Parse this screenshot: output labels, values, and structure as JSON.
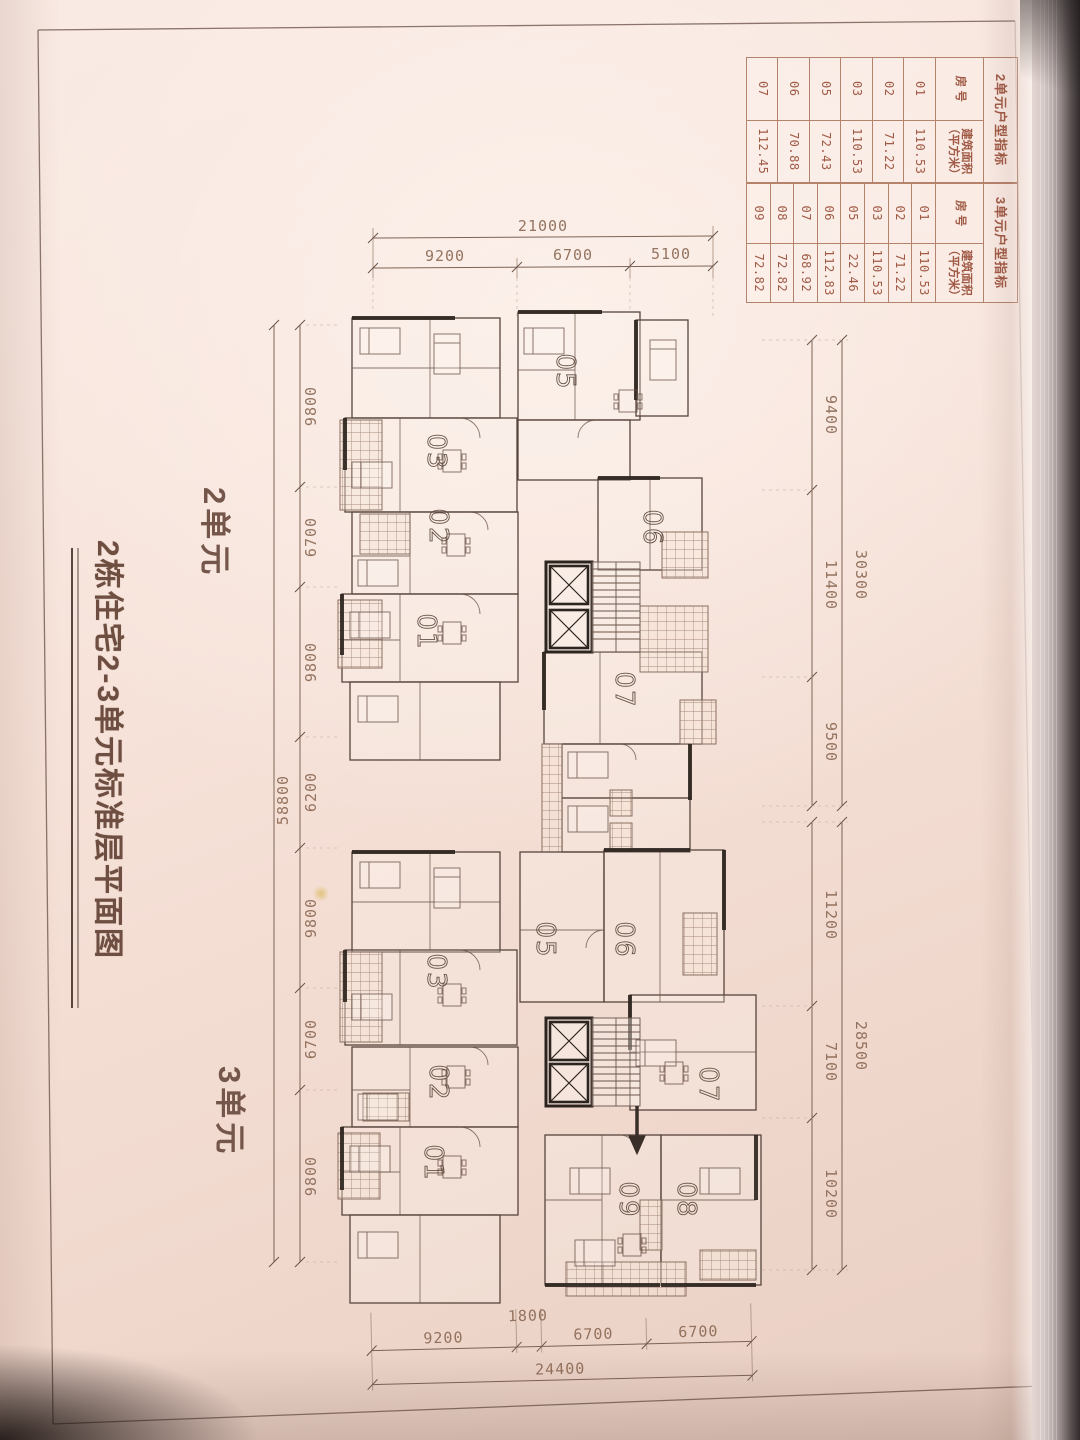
{
  "page": {
    "title": "2栋住宅2-3单元标准层平面图",
    "unit2_label": "2单元",
    "unit3_label": "3单元"
  },
  "tables": {
    "unit2": {
      "title": "2单元户型指标",
      "room_col": "房 号",
      "area_col": "建筑面积\n（平方米）",
      "rows": [
        [
          "01",
          "110.53"
        ],
        [
          "02",
          "71.22"
        ],
        [
          "03",
          "110.53"
        ],
        [
          "05",
          "72.43"
        ],
        [
          "06",
          "70.88"
        ],
        [
          "07",
          "112.45"
        ]
      ]
    },
    "unit3": {
      "title": "3单元户型指标",
      "room_col": "房 号",
      "area_col": "建筑面积\n（平方米）",
      "rows": [
        [
          "01",
          "110.53"
        ],
        [
          "02",
          "71.22"
        ],
        [
          "03",
          "110.53"
        ],
        [
          "05",
          "22.46"
        ],
        [
          "06",
          "112.83"
        ],
        [
          "07",
          "68.92"
        ],
        [
          "08",
          "72.82"
        ],
        [
          "09",
          "72.82"
        ]
      ]
    }
  },
  "dimensions": {
    "top": {
      "total": "21000",
      "segments": [
        "9200",
        "6700",
        "5100"
      ]
    },
    "left": {
      "total": "58800",
      "segments": [
        "9800",
        "6700",
        "9800",
        "6200",
        "9800",
        "6700",
        "9800"
      ]
    },
    "right_upper": {
      "total": "30300",
      "segments": [
        "9400",
        "11400",
        "9500"
      ]
    },
    "right_lower": {
      "total": "28500",
      "segments": [
        "11200",
        "7100",
        "10200"
      ]
    },
    "bottom": {
      "total": "24400",
      "segments": [
        "9200",
        "1800",
        "6700",
        "6700"
      ]
    }
  },
  "plan": {
    "unit2_rooms": [
      "05",
      "03",
      "02",
      "01",
      "06",
      "07"
    ],
    "unit3_rooms": [
      "03",
      "05",
      "06",
      "02",
      "07",
      "01",
      "09",
      "08"
    ]
  }
}
